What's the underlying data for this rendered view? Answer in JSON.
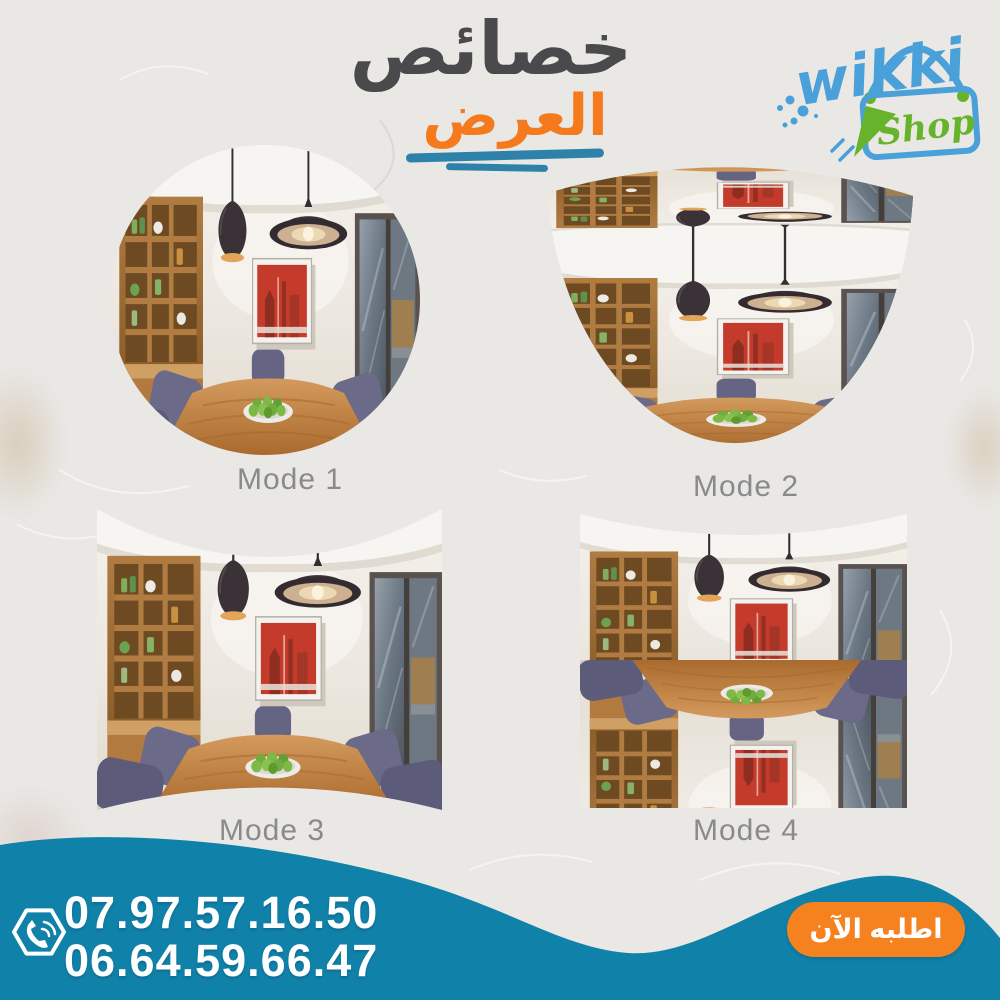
{
  "poster": {
    "background_color": "#e9e8e5",
    "texture": "crumpled-paper"
  },
  "header": {
    "title_line1": "خصائص",
    "title_line2": "العرض",
    "title_line1_color": "#4a4a4c",
    "title_line2_color": "#f5791d",
    "underline_color": "#2e81a8"
  },
  "logo": {
    "name": "wikki",
    "sub": "Shop",
    "name_color": "#4aa0d8",
    "sub_color": "#68b32c",
    "icons": [
      "shopping-bag-icon",
      "cursor-arrow-icon",
      "splash-dots-icon"
    ]
  },
  "modes": [
    {
      "label": "Mode 1",
      "view": "circular-fisheye-panorama"
    },
    {
      "label": "Mode 2",
      "view": "bowl-arc-panorama"
    },
    {
      "label": "Mode 3",
      "view": "wide-pincushion-panorama"
    },
    {
      "label": "Mode 4",
      "view": "split-mirror-panorama"
    }
  ],
  "scene": {
    "description": "dining room with two pendant lamps, wooden shelf unit, red framed picture, glass door, wooden table with plate of green apples and purple chairs"
  },
  "footer": {
    "phone1": "07.97.57.16.50",
    "phone2": "06.64.59.66.47",
    "phone_icon": "phone-hexagon-icon",
    "wave_color": "#1081a8",
    "cta_label": "اطلبه الآن",
    "cta_color": "#f5821f",
    "text_color": "#ffffff"
  }
}
